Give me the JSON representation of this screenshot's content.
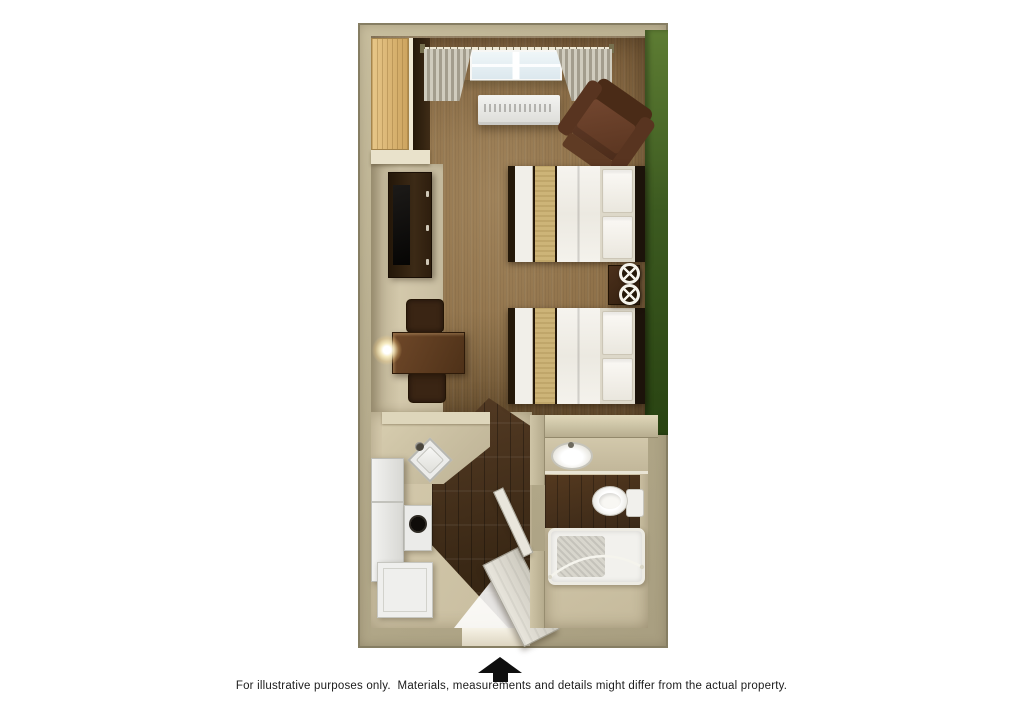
{
  "footer": {
    "disclaimer": "For illustrative purposes only.  Materials, measurements and details might differ from the actual property.",
    "entrance_marker": "up-arrow"
  },
  "plan": {
    "kind": "hotel-studio-floor-plan",
    "rooms": [
      {
        "name": "main-room",
        "items": [
          "closet",
          "window",
          "curtains",
          "curtain-rod",
          "ac-unit",
          "armchair",
          "tv-stand",
          "tv",
          "dining-table",
          "dining-chair",
          "dining-chair",
          "floor-lamp",
          "double-bed",
          "double-bed",
          "nightstand",
          "table-lamp",
          "table-lamp",
          "green-accent-wall",
          "carpet-floor"
        ]
      },
      {
        "name": "kitchen",
        "items": [
          "counter",
          "corner-sink",
          "faucet",
          "refrigerator",
          "stove",
          "base-cabinet",
          "wood-floor",
          "entry-door"
        ]
      },
      {
        "name": "bathroom",
        "items": [
          "vanity-counter",
          "sink",
          "toilet",
          "bathtub",
          "shower-rod",
          "bathroom-door",
          "wood-floor"
        ]
      }
    ],
    "colors": {
      "wall_tan": "#b3a98a",
      "accent_wall_green": "#3c5a20",
      "carpet_brown": "#8e7048",
      "wood_floor_dark": "#3a2815",
      "vinyl_beige": "#cfc4a7",
      "fixtures_white": "#efeeea",
      "bed_runner_tan": "#cdb478",
      "furniture_dark_brown": "#3c2a16",
      "arrow_black": "#0f0f0f",
      "background": "#ffffff"
    }
  }
}
